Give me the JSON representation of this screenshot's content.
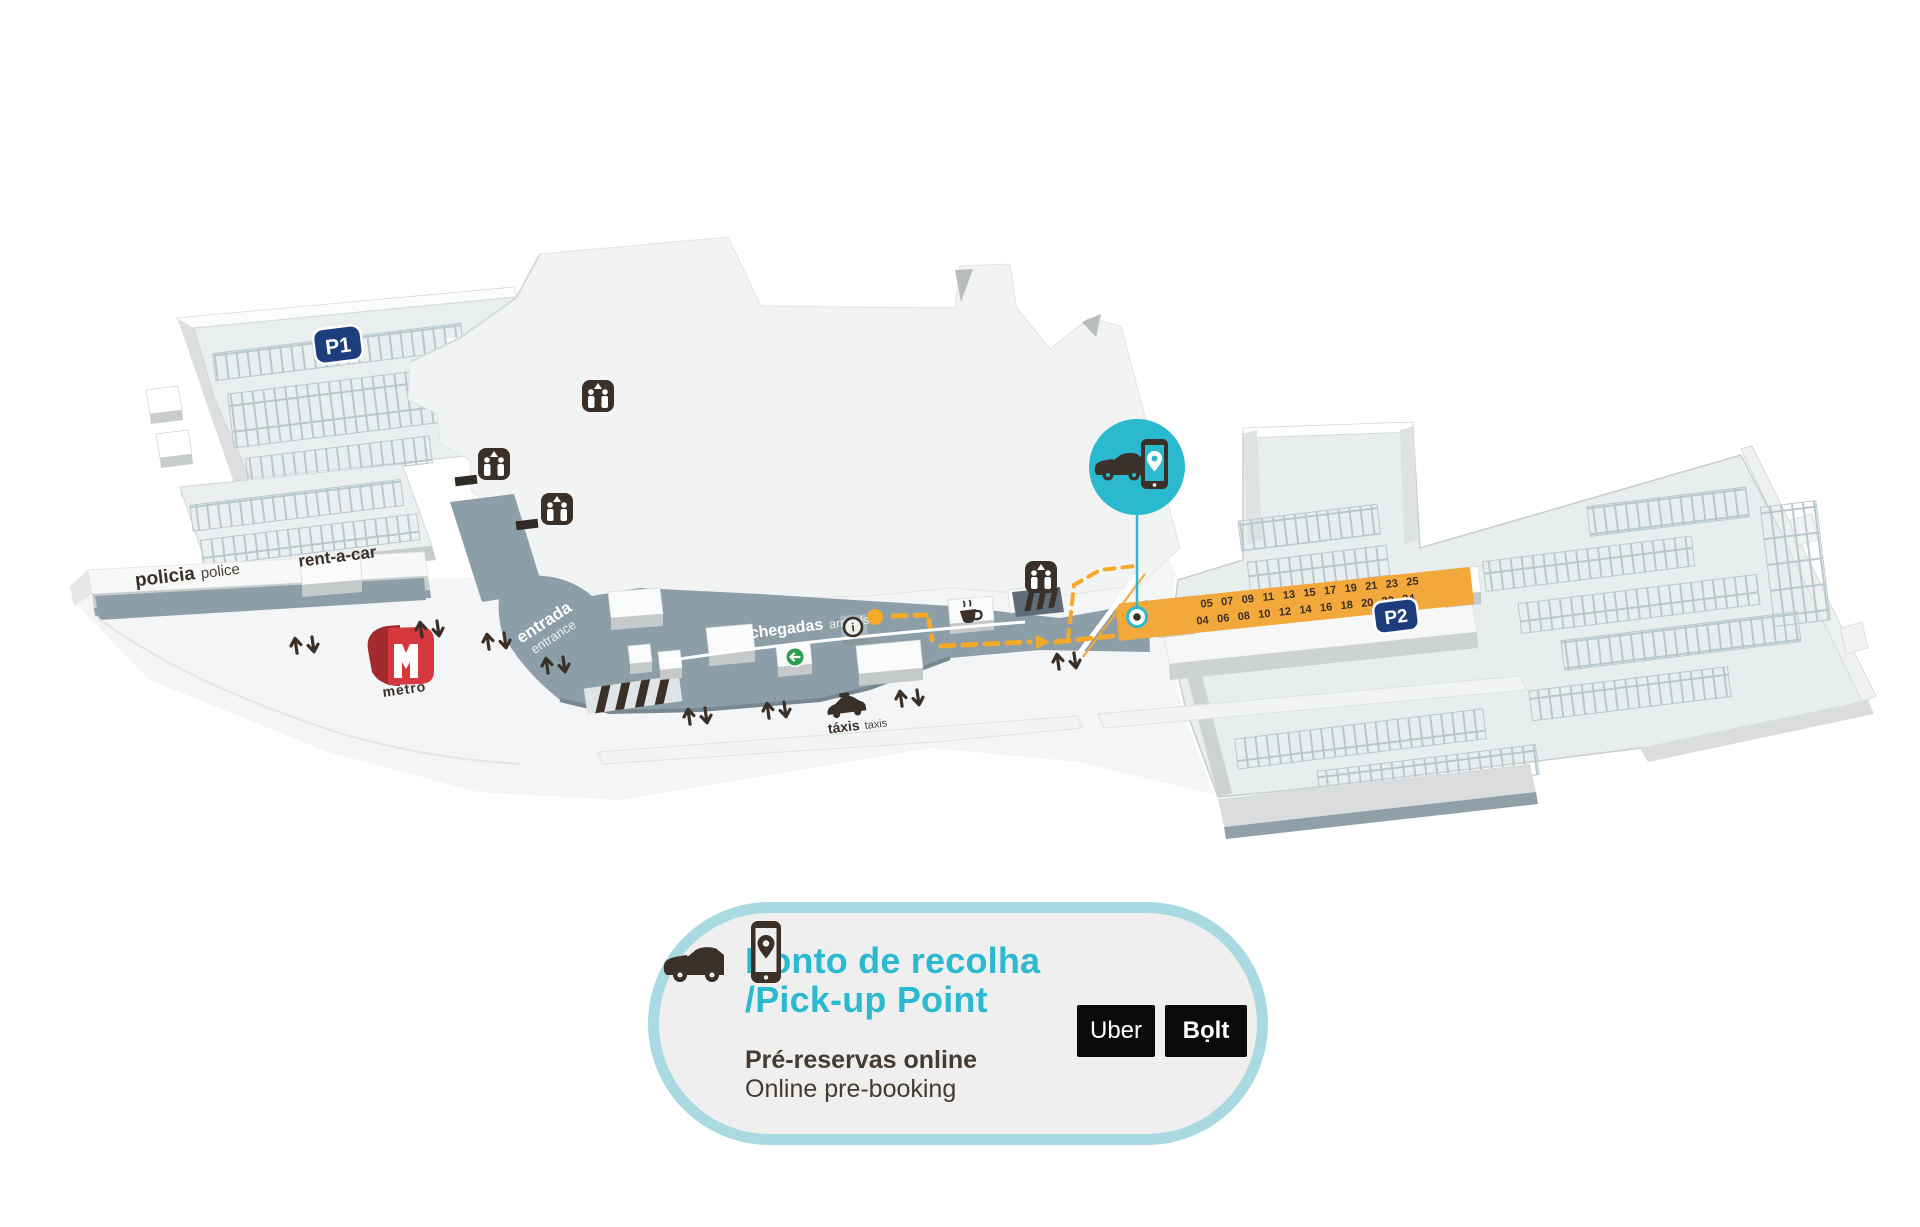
{
  "map": {
    "parking_p1_label": "P1",
    "parking_p2_label": "P2",
    "policia": {
      "pt": "policia",
      "en": "police"
    },
    "rent_a_car_label": "rent-a-car",
    "entrada": {
      "pt": "entrada",
      "en": "entrance"
    },
    "chegadas": {
      "pt": "chegadas",
      "en": "arrivals"
    },
    "taxis": {
      "pt": "táxis",
      "en": "taxis"
    },
    "metro_label": "metro",
    "pickup_bays": {
      "top_row": [
        "05",
        "07",
        "09",
        "11",
        "13",
        "15",
        "17",
        "19",
        "21",
        "23",
        "25"
      ],
      "bottom_row": [
        "04",
        "06",
        "08",
        "10",
        "12",
        "14",
        "16",
        "18",
        "20",
        "22",
        "24"
      ]
    }
  },
  "legend": {
    "title_pt": "Ponto de recolha",
    "title_en": "/Pick-up Point",
    "subtitle_pt": "Pré-reservas online",
    "subtitle_en": "Online pre-booking",
    "providers": [
      {
        "label": "Uber"
      },
      {
        "label": "Bọlt"
      }
    ]
  },
  "icons": {
    "pickup_point": "car-with-phone-icon",
    "elevator": "elevator-icon",
    "escalator": "escalator-icon",
    "info": "info-icon",
    "exit": "exit-arrow-icon",
    "cafe": "coffee-cup-icon",
    "taxi": "taxi-car-icon",
    "metro": "metro-logo",
    "two_way_traffic": "up-down-arrows-icon"
  },
  "colors": {
    "pickup_strip_orange": "#F2A83B",
    "pickup_teal": "#2BB9CF",
    "parking_badge_navy": "#1E3D7D",
    "walkway_gray": "#8C9EA7",
    "dark_brown": "#3B3027",
    "metro_red": "#D5383D",
    "exit_green": "#2F9E50",
    "legend_border": "#A9DAE1"
  }
}
